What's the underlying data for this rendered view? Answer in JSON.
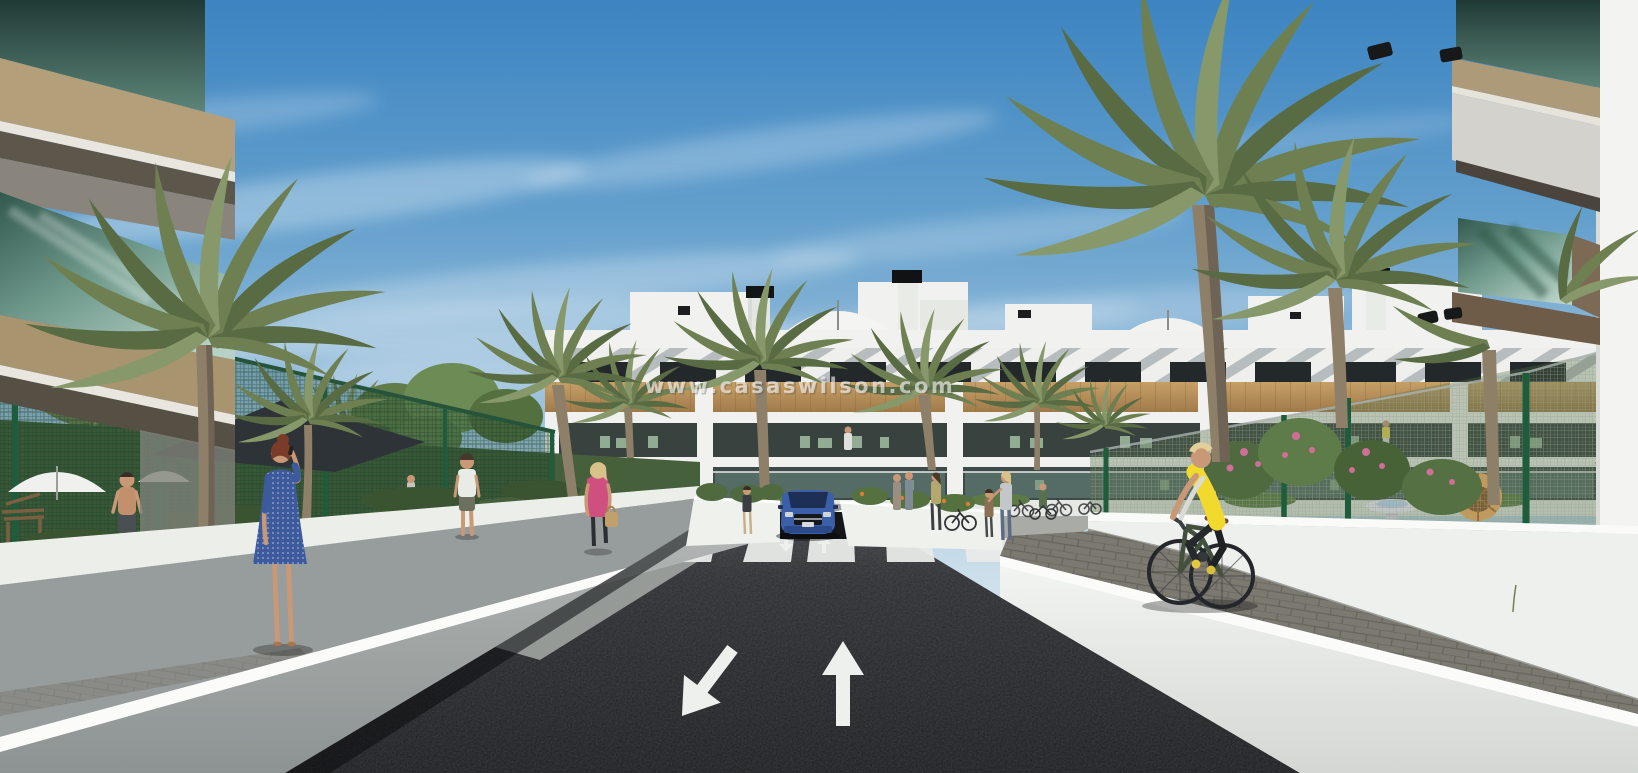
{
  "scene": {
    "type": "architectural-render-street-view",
    "watermark": "www.casaswilson.com",
    "road": {
      "left_lane_marking": "turn-arrow-down-left",
      "right_lane_marking": "straight-arrow-up",
      "crosswalk_stripes": 6
    },
    "colors": {
      "sky_top": "#3c84c2",
      "sky_horizon": "#ecf1f3",
      "asphalt_dark": "#1a1b1e",
      "marking_white": "#eef0ee",
      "wall_white": "#f0f2ef",
      "wood_cladding": "#bb945d",
      "palm_frond": "#6e8052",
      "fence_green": "#1f5c3c",
      "glass_teal": "#6f9a8c",
      "car_blue": "#3b5fa8",
      "vest_yellow": "#f2d92e",
      "dress_blue": "#3d5a9c",
      "top_pink": "#cf4f7e"
    }
  }
}
